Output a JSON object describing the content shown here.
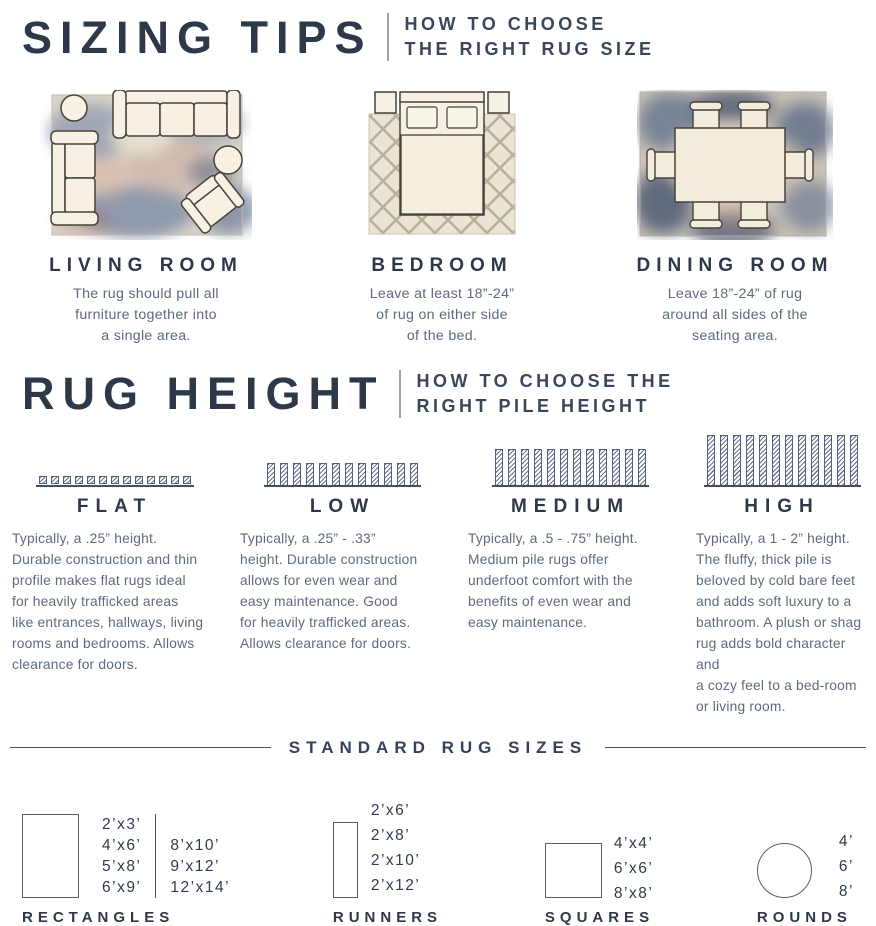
{
  "page": {
    "background": "#ffffff",
    "accent_navy": "#2d3949",
    "body_text_color": "#5d6b7e"
  },
  "sizing_tips": {
    "title": "SIZING TIPS",
    "subtitle": "HOW TO CHOOSE\nTHE RIGHT RUG SIZE",
    "rooms": [
      {
        "name": "LIVING ROOM",
        "description": "The rug should pull all\nfurniture together into\na single area."
      },
      {
        "name": "BEDROOM",
        "description": "Leave at least 18”-24”\nof rug on either side\nof the bed."
      },
      {
        "name": "DINING ROOM",
        "description": "Leave 18”-24” of rug\naround all sides of the\nseating area."
      }
    ]
  },
  "rug_height": {
    "title": "RUG HEIGHT",
    "subtitle": "HOW TO CHOOSE THE\nRIGHT PILE HEIGHT",
    "piles": [
      {
        "name": "FLAT",
        "typical_height": ".25”",
        "description": "Typically, a .25” height.\nDurable construction and thin\nprofile makes flat rugs ideal\nfor heavily trafficked areas\nlike entrances, hallways, living\nrooms and bedrooms. Allows\nclearance for doors."
      },
      {
        "name": "LOW",
        "typical_height": ".25” - .33”",
        "description": "Typically, a .25” - .33”\nheight. Durable construction\nallows for even wear and\neasy maintenance. Good\nfor heavily trafficked areas.\nAllows clearance for doors."
      },
      {
        "name": "MEDIUM",
        "typical_height": ".5 - .75”",
        "description": "Typically, a .5 - .75” height.\nMedium pile rugs offer\nunderfoot comfort with the\nbenefits of even wear and\neasy maintenance."
      },
      {
        "name": "HIGH",
        "typical_height": "1 - 2”",
        "description": "Typically, a 1 - 2” height.\nThe fluffy, thick pile is\nbeloved by cold bare feet\nand adds soft luxury to a\nbathroom. A plush or shag\nrug adds bold character and\na cozy feel to a bed-room\nor living room."
      }
    ]
  },
  "standard_sizes": {
    "title": "STANDARD RUG SIZES",
    "groups": [
      {
        "name": "RECTANGLES",
        "shape": "rectangle",
        "col1": [
          "2’x3’",
          "4’x6’",
          "5’x8’",
          "6’x9’"
        ],
        "col2": [
          "8’x10’",
          "9’x12’",
          "12’x14’"
        ]
      },
      {
        "name": "RUNNERS",
        "shape": "runner",
        "col1": [
          "2’x6’",
          "2’x8’",
          "2’x10’",
          "2’x12’"
        ]
      },
      {
        "name": "SQUARES",
        "shape": "square",
        "col1": [
          "4’x4’",
          "6’x6’",
          "8’x8’"
        ]
      },
      {
        "name": "ROUNDS",
        "shape": "circle",
        "col1": [
          "4’",
          "6’",
          "8’"
        ]
      }
    ]
  }
}
